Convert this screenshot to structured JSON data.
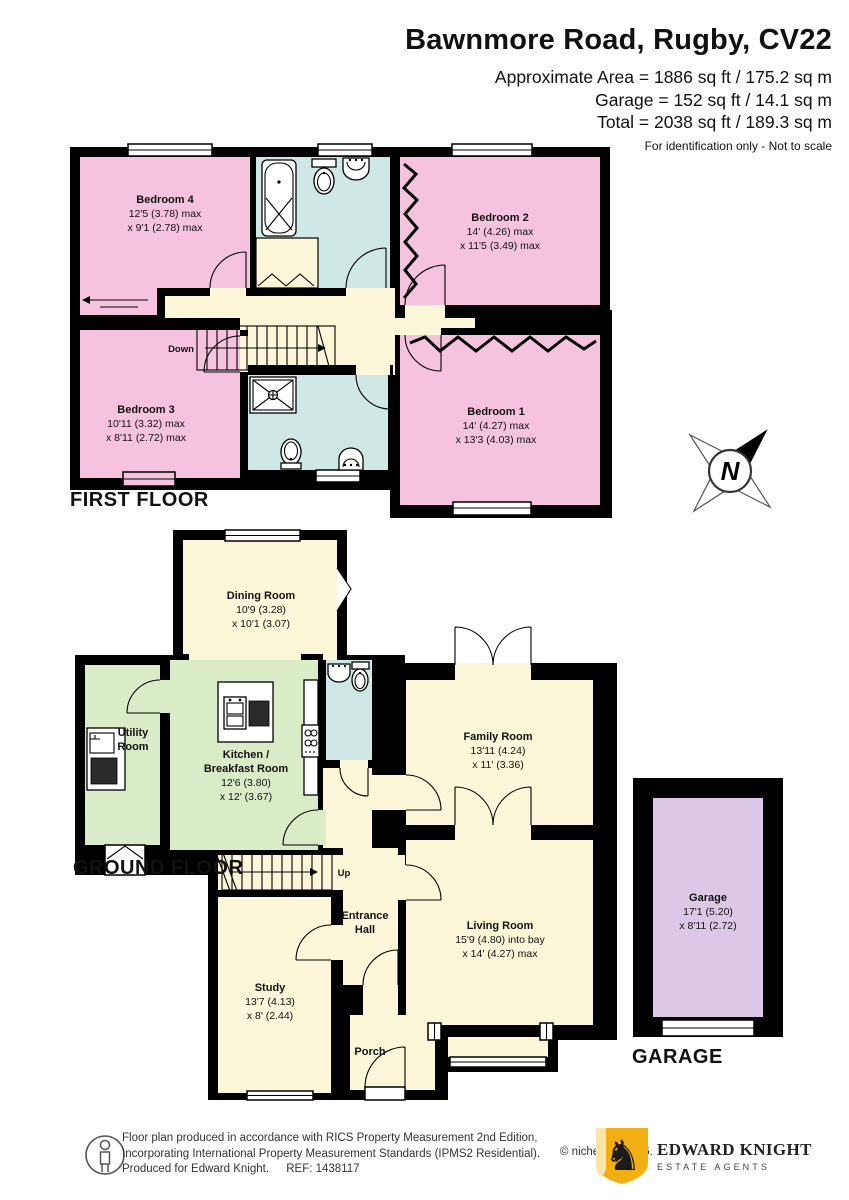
{
  "header": {
    "title": "Bawnmore Road, Rugby, CV22",
    "area_line": "Approximate Area = 1886 sq ft / 175.2 sq m",
    "garage_line": "Garage = 152 sq ft / 14.1 sq m",
    "total_line": "Total = 2038 sq ft / 189.3 sq m",
    "note": "For identification only - Not to scale"
  },
  "first_floor": {
    "label": "FIRST FLOOR",
    "down_label": "Down",
    "rooms": {
      "bedroom4": {
        "name": "Bedroom 4",
        "dim1": "12'5 (3.78) max",
        "dim2": "x 9'1 (2.78) max"
      },
      "bedroom2": {
        "name": "Bedroom 2",
        "dim1": "14' (4.26) max",
        "dim2": "x 11'5 (3.49) max"
      },
      "bedroom3": {
        "name": "Bedroom 3",
        "dim1": "10'11 (3.32) max",
        "dim2": "x 8'11 (2.72) max"
      },
      "bedroom1": {
        "name": "Bedroom 1",
        "dim1": "14' (4.27) max",
        "dim2": "x 13'3 (4.03) max"
      }
    }
  },
  "ground_floor": {
    "label": "GROUND FLOOR",
    "up_label": "Up",
    "rooms": {
      "dining": {
        "name": "Dining Room",
        "dim1": "10'9 (3.28)",
        "dim2": "x 10'1 (3.07)"
      },
      "utility": {
        "name1": "Utility",
        "name2": "Room"
      },
      "kitchen": {
        "name1": "Kitchen /",
        "name2": "Breakfast Room",
        "dim1": "12'6 (3.80)",
        "dim2": "x 12' (3.67)"
      },
      "family": {
        "name": "Family Room",
        "dim1": "13'11 (4.24)",
        "dim2": "x 11' (3.36)"
      },
      "living": {
        "name": "Living Room",
        "dim1": "15'9 (4.80) into bay",
        "dim2": "x 14' (4.27) max"
      },
      "study": {
        "name": "Study",
        "dim1": "13'7 (4.13)",
        "dim2": "x 8' (2.44)"
      },
      "entrance": {
        "name1": "Entrance",
        "name2": "Hall"
      },
      "porch": {
        "name": "Porch"
      }
    }
  },
  "garage": {
    "label": "GARAGE",
    "name": "Garage",
    "dim1": "17'1 (5.20)",
    "dim2": "x 8'11 (2.72)"
  },
  "compass": {
    "letter": "N"
  },
  "footer": {
    "line1": "Floor plan produced in accordance with RICS Property Measurement 2nd Edition,",
    "line2": "Incorporating International Property Measurement Standards (IPMS2 Residential).",
    "line3": "Produced for Edward Knight.",
    "ref": "REF: 1438117",
    "copyright": "© nichecom 2026.",
    "brand": {
      "name": "EDWARD KNIGHT",
      "tagline": "ESTATE AGENTS"
    }
  },
  "colors": {
    "bedroom_pink": "#F6C3DF",
    "bathroom_blue": "#CFE7E5",
    "living_cream": "#FCF7D9",
    "kitchen_green": "#DAECC7",
    "garage_lilac": "#DCC7E6",
    "wall_black": "#000000",
    "brand_gold": "#F2AF13"
  }
}
